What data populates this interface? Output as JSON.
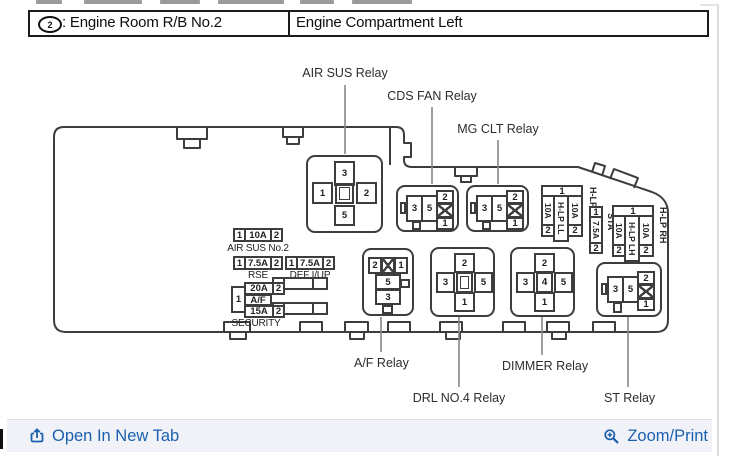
{
  "header": {
    "badge": "2",
    "title_left": ": Engine Room R/B No.2",
    "title_right": "Engine Compartment Left"
  },
  "relay_labels": {
    "air_sus": "AIR SUS Relay",
    "cds_fan": "CDS FAN Relay",
    "mg_clt": "MG CLT Relay",
    "af": "A/F Relay",
    "drl_no4": "DRL NO.4 Relay",
    "dimmer": "DIMMER Relay",
    "st": "ST Relay"
  },
  "relays": {
    "air_sus": {
      "top": "3",
      "left": "1",
      "right": "2",
      "bottom": "5"
    },
    "cds_fan": {
      "left": "3",
      "right": "5",
      "col_top": "2",
      "col_bottom": "1"
    },
    "mg_clt": {
      "left": "3",
      "right": "5",
      "col_top": "2",
      "col_bottom": "1"
    },
    "st": {
      "left": "3",
      "right": "5",
      "col_top": "2",
      "col_bottom": "1"
    },
    "af": {
      "row_left": "2",
      "row_right": "1",
      "mid": "5",
      "bottom": "3"
    },
    "drl_no4": {
      "top": "2",
      "left": "3",
      "right": "5",
      "bottom": "1"
    },
    "dimmer": {
      "top": "2",
      "left": "3",
      "right": "5",
      "bottom": "1",
      "center": "4"
    }
  },
  "fuses": {
    "air_sus_no2": {
      "t1": "1",
      "amp": "10A",
      "t2": "2",
      "label": "AIR SUS No.2"
    },
    "rse": {
      "t1": "1",
      "amp": "7.5A",
      "t2": "2",
      "label": "RSE"
    },
    "def_iup": {
      "t1": "1",
      "amp": "7.5A",
      "t2": "2",
      "label": "DEF I/UP"
    },
    "security_block": {
      "shared": "1",
      "amp_top": "20A",
      "t2_top": "2",
      "mid_label": "A/F",
      "amp_bot": "15A",
      "t2_bot": "2",
      "label": "SECURITY"
    },
    "hlp_left": {
      "t1": "1",
      "col1_amp": "10A",
      "col1_t2": "2",
      "mid": "H-LP LL",
      "col2_amp": "10A",
      "col2_t2": "2",
      "side": "H-LP RL"
    },
    "sta": {
      "t1": "1",
      "amp": "7.5A",
      "t2": "2",
      "side": "STA"
    },
    "hlp_right": {
      "t1": "1",
      "col1_amp": "10A",
      "col1_t2": "2",
      "mid": "H-LP LH",
      "col2_amp": "10A",
      "col2_t2": "2",
      "side": "H-LP RH"
    }
  },
  "footer": {
    "open_in_new_tab": "Open In New Tab",
    "zoom_print": "Zoom/Print"
  },
  "colors": {
    "link": "#1b60ae",
    "diagram_stroke": "#3d3d3d"
  }
}
